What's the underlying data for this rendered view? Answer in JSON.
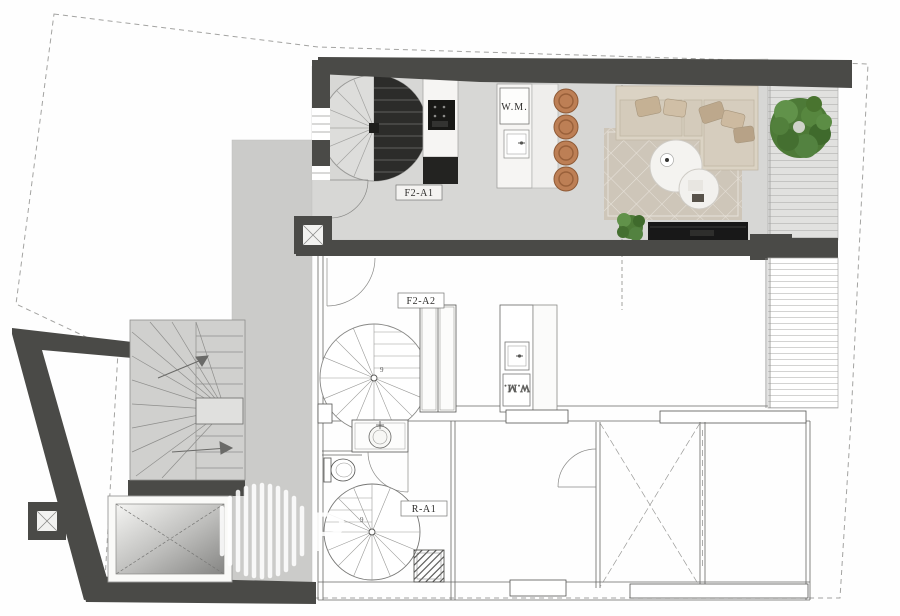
{
  "labels": {
    "unit_upper": "F2-A1",
    "unit_middle": "F2-A2",
    "unit_lower": "R-A1",
    "washing_machine_upper": "W.M.",
    "washing_machine_lower": "W.M.",
    "stair_count_middle": "9",
    "stair_count_lower": "9"
  },
  "watermark": {
    "letter": "P"
  },
  "colors": {
    "wall_dark": "#4a4a47",
    "floor_rendered": "#d7d7d5",
    "terrace_gray": "#cbcbc9",
    "deck_plank": "#e1e1df",
    "rug": "#cec6b9",
    "sofa": "#dbd3c4",
    "stool_copper": "#bd7f55",
    "plant_green": "#4d7a37",
    "tv_console": "#181818",
    "stair_dark": "#2c2c2a",
    "marble": "#f6f5f3",
    "boundary": "#a3a3a1",
    "label_ink": "#2e2d2b",
    "watermark_white": "#ffffff"
  }
}
